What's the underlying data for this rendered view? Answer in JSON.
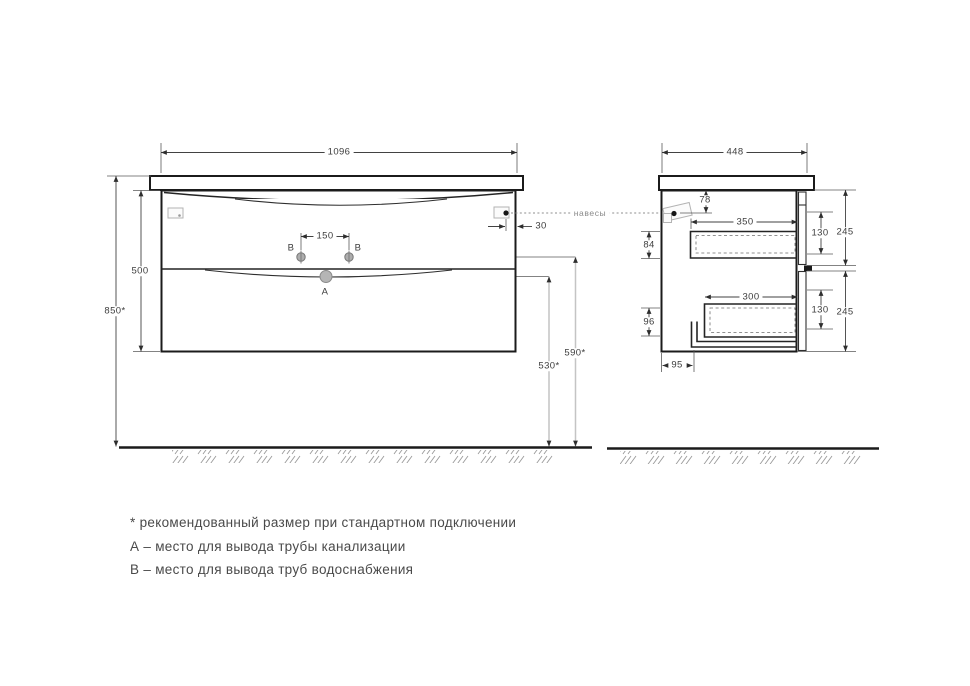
{
  "front_view": {
    "labels": {
      "width": "1096",
      "overall_height": "850*",
      "cabinet_height": "500",
      "outlet_spacing": "150",
      "hanger_inset": "30",
      "water_outlet_height": "590*",
      "drain_outlet_height": "530*",
      "hangers_note": "навесы",
      "point_a": "A",
      "point_b_left": "B",
      "point_b_right": "B"
    }
  },
  "side_view": {
    "labels": {
      "depth": "448",
      "hanger_from_top": "78",
      "top_drawer_depth": "350",
      "top_drawer_back_height": "84",
      "top_drawer_inner_height": "130",
      "top_front_height": "245",
      "bottom_drawer_depth": "300",
      "bottom_drawer_back_height": "96",
      "bottom_drawer_inner_height": "130",
      "bottom_front_height": "245",
      "siphon_recess_depth": "95"
    }
  },
  "legend": {
    "line1": "* рекомендованный размер при стандартном подключении",
    "line2": "А – место для вывода трубы канализации",
    "line3": "В – место для вывода труб водоснабжения"
  },
  "colors": {
    "outline": "#1b1b1b",
    "dimension": "#424242",
    "light_dimension": "#c4c4c4",
    "hatch": "#9a9a9a",
    "background": "#ffffff"
  }
}
